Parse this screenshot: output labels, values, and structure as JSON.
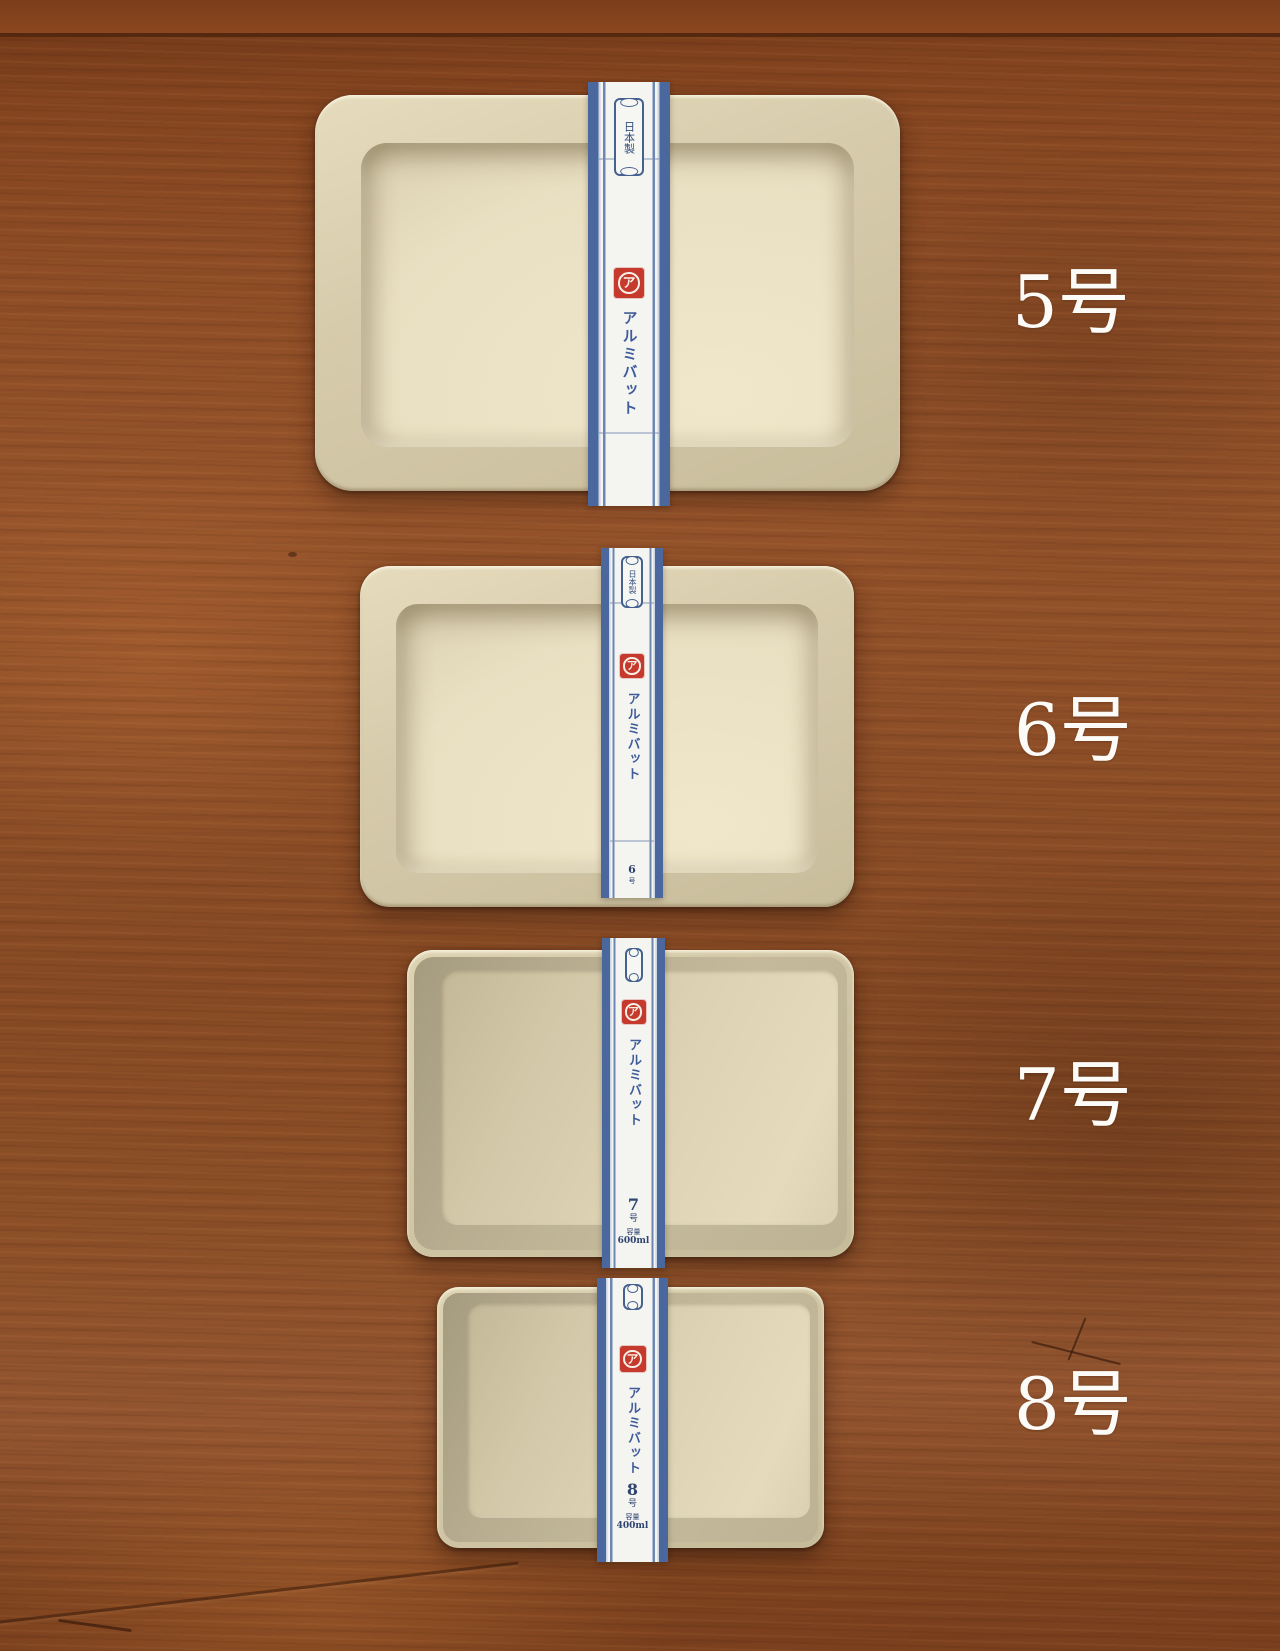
{
  "trays": [
    {
      "name": "aluminum-tray-5",
      "label": "5号",
      "band": {
        "seal": "日本製",
        "logo": "ア",
        "brand": "アルミバット",
        "size_mark": "",
        "size_unit": "",
        "capacity_label": "",
        "capacity": ""
      }
    },
    {
      "name": "aluminum-tray-6",
      "label": "6号",
      "band": {
        "seal": "日本製",
        "logo": "ア",
        "brand": "アルミバット",
        "size_mark": "6",
        "size_unit": "号",
        "capacity_label": "",
        "capacity": ""
      }
    },
    {
      "name": "aluminum-tray-7",
      "label": "7号",
      "band": {
        "seal": "",
        "logo": "ア",
        "brand": "アルミバット",
        "size_mark": "7",
        "size_unit": "号",
        "capacity_label": "容量",
        "capacity": "600ml"
      }
    },
    {
      "name": "aluminum-tray-8",
      "label": "8号",
      "band": {
        "seal": "",
        "logo": "ア",
        "brand": "アルミバット",
        "size_mark": "8",
        "size_unit": "号",
        "capacity_label": "容量",
        "capacity": "400ml"
      }
    }
  ],
  "colors": {
    "wood_base": "#8e4d26",
    "wood_dark": "#6f3718",
    "wood_light": "#a5622f",
    "tray_metal": "#d4caaa",
    "tray_floor": "#eadfc4",
    "band_blue": "#4a689e",
    "band_stripe": "#6e87b2",
    "band_white": "#f4f4f0",
    "brand_text_blue": "#3f5c9a",
    "logo_red": "#c6392d",
    "caption_white": "#fcfbf7"
  }
}
